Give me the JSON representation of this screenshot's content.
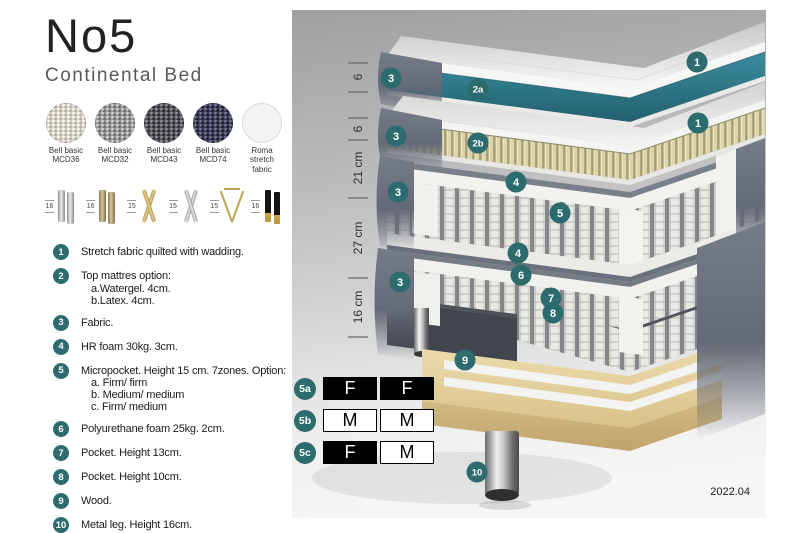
{
  "header": {
    "title": "No5",
    "subtitle": "Continental Bed"
  },
  "fabrics": [
    {
      "line1": "Bell basic",
      "line2": "MCD36"
    },
    {
      "line1": "Bell basic",
      "line2": "MCD32"
    },
    {
      "line1": "Bell basic",
      "line2": "MCD43"
    },
    {
      "line1": "Bell basic",
      "line2": "MCD74"
    },
    {
      "line1": "Roma",
      "line2": "stretch fabric"
    }
  ],
  "legs": [
    {
      "height": "16",
      "type": "cylinder-silver"
    },
    {
      "height": "16",
      "type": "cylinder-bronze"
    },
    {
      "height": "15",
      "type": "cross-gold"
    },
    {
      "height": "15",
      "type": "cross-silver"
    },
    {
      "height": "15",
      "type": "hairpin-gold"
    },
    {
      "height": "16",
      "type": "straight-black-gold"
    }
  ],
  "legend": [
    {
      "num": "1",
      "text": "Stretch fabric quilted with wadding."
    },
    {
      "num": "2",
      "text": "Top mattres option:",
      "sub": [
        "a.Watergel. 4cm.",
        "b.Latex. 4cm."
      ]
    },
    {
      "num": "3",
      "text": "Fabric."
    },
    {
      "num": "4",
      "text": "HR foam 30kg. 3cm."
    },
    {
      "num": "5",
      "text": "Micropocket. Height 15 cm. 7zones. Option:",
      "sub": [
        "a. Firm/ firm",
        "b. Medium/ medium",
        "c. Firm/ medium"
      ]
    },
    {
      "num": "6",
      "text": "Polyurethane foam 25kg. 2cm."
    },
    {
      "num": "7",
      "text": "Pocket. Height 13cm."
    },
    {
      "num": "8",
      "text": "Pocket. Height 10cm."
    },
    {
      "num": "9",
      "text": "Wood."
    },
    {
      "num": "10",
      "text": "Metal leg. Height 16cm."
    }
  ],
  "diagram": {
    "dimensions": [
      "6",
      "6",
      "21 cm",
      "27 cm",
      "16 cm"
    ],
    "callouts": [
      "3",
      "2a",
      "1",
      "3",
      "2b",
      "1",
      "4",
      "5",
      "4",
      "3",
      "6",
      "7",
      "3",
      "8",
      "9",
      "10"
    ]
  },
  "firmness": {
    "rows": [
      {
        "id": "5a",
        "cells": [
          "F",
          "F"
        ]
      },
      {
        "id": "5b",
        "cells": [
          "M",
          "M"
        ]
      },
      {
        "id": "5c",
        "cells": [
          "F",
          "M"
        ]
      }
    ]
  },
  "version": "2022.04",
  "colors": {
    "accent_teal": "#2c6b6e",
    "watergel_teal": "#2e7787",
    "latex_cream": "#d9d2a4",
    "fabric_gray": "#656b77",
    "wood": "#e4d3a2"
  }
}
